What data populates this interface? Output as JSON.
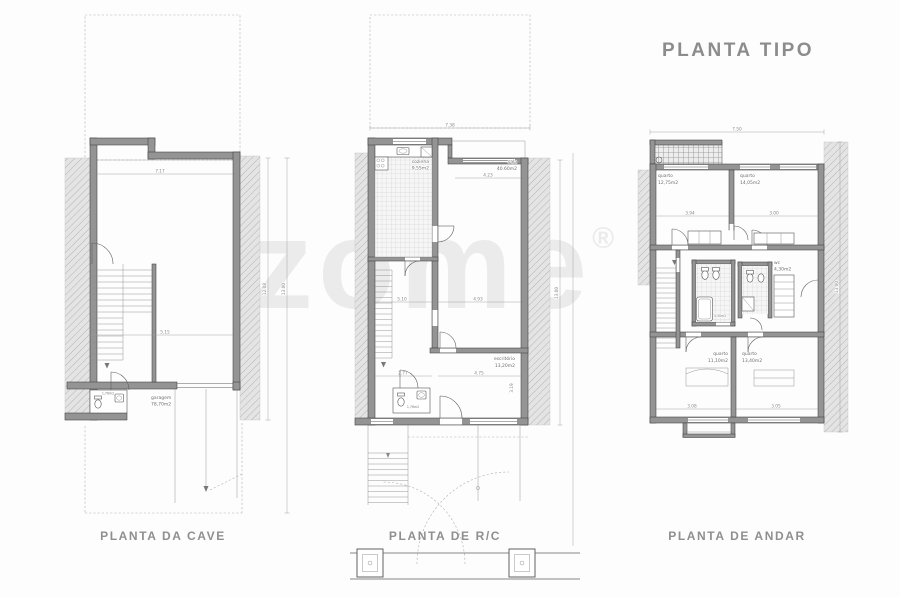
{
  "title": "PLANTA TIPO",
  "watermark": {
    "text": "zome",
    "mark": "®"
  },
  "plans": {
    "cave": {
      "label": "PLANTA DA CAVE",
      "rooms": {
        "garagem": {
          "name": "garagem",
          "area": "78,70m2"
        },
        "wc": {
          "area": "1,76m2"
        }
      },
      "dims": {
        "width_total": "7.50",
        "width_inner": "7.17",
        "garage_width": "5.15",
        "height_inner": "12.08",
        "height_total": "13.00"
      }
    },
    "rc": {
      "label": "PLANTA DE R/C",
      "rooms": {
        "cozinha": {
          "name": "cozinha",
          "area": "9,55m2"
        },
        "sala": {
          "name": "sala",
          "area": "40.60m2"
        },
        "escritorio": {
          "name": "escritório",
          "area": "13,20m2"
        },
        "wc": {
          "area": "1,76m2"
        }
      },
      "dims": {
        "width_total": "7.38",
        "sala_width": "4.23",
        "hall_width": "2.77",
        "escritorio_width": "4.75",
        "escritorio_height": "3.19",
        "left_mid": "5.10",
        "right_mid": "4.93",
        "height_total": "13.00"
      }
    },
    "andar": {
      "label": "PLANTA DE ANDAR",
      "rooms": {
        "quarto1": {
          "name": "quarto",
          "area": "12,75m2"
        },
        "quarto2": {
          "name": "quarto",
          "area": "14,05m2"
        },
        "quarto3": {
          "name": "quarto",
          "area": "11,10m2"
        },
        "quarto4": {
          "name": "quarto",
          "area": "13,40m2"
        },
        "wc1": {
          "area": "4,30m2"
        },
        "wc2": {
          "name": "wc",
          "area": "4,30m2"
        }
      },
      "dims": {
        "width_total": "7.50",
        "q1_width": "3.94",
        "q2_width": "3.00",
        "q3_width": "3.08",
        "q4_width": "3.05",
        "height_total": "13.00"
      }
    }
  }
}
